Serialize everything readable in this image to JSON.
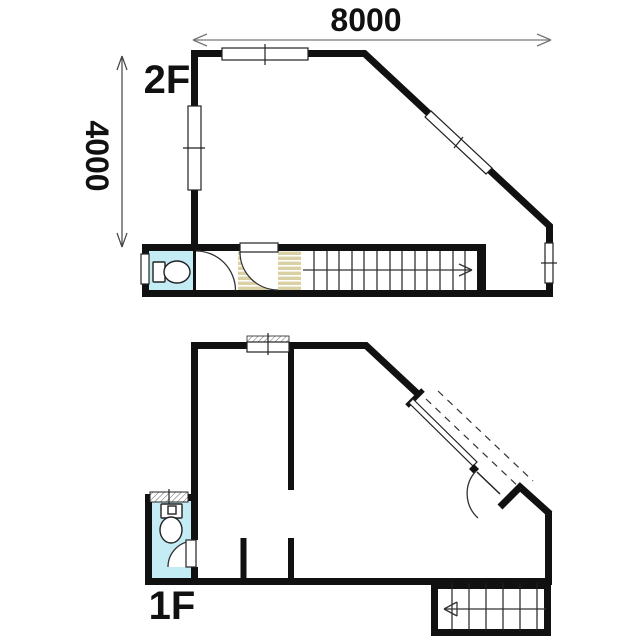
{
  "page": {
    "background": "#ffffff",
    "kind": "two-storey floor plan drawing"
  },
  "dimensions": {
    "width_label": "8000",
    "height_label": "4000"
  },
  "floors": {
    "second": {
      "label": "2F"
    },
    "first": {
      "label": "1F"
    }
  },
  "colors": {
    "room_fill": "#f6f6b8",
    "wet_room_fill": "#c4ecf4",
    "wall": "#111111",
    "stair_landing_stripe": "#d9d0a4",
    "dimension_line": "#777777"
  },
  "icons": {
    "toilet": "toilet-plan-icon",
    "stair_direction": "direction-arrow-icon"
  }
}
